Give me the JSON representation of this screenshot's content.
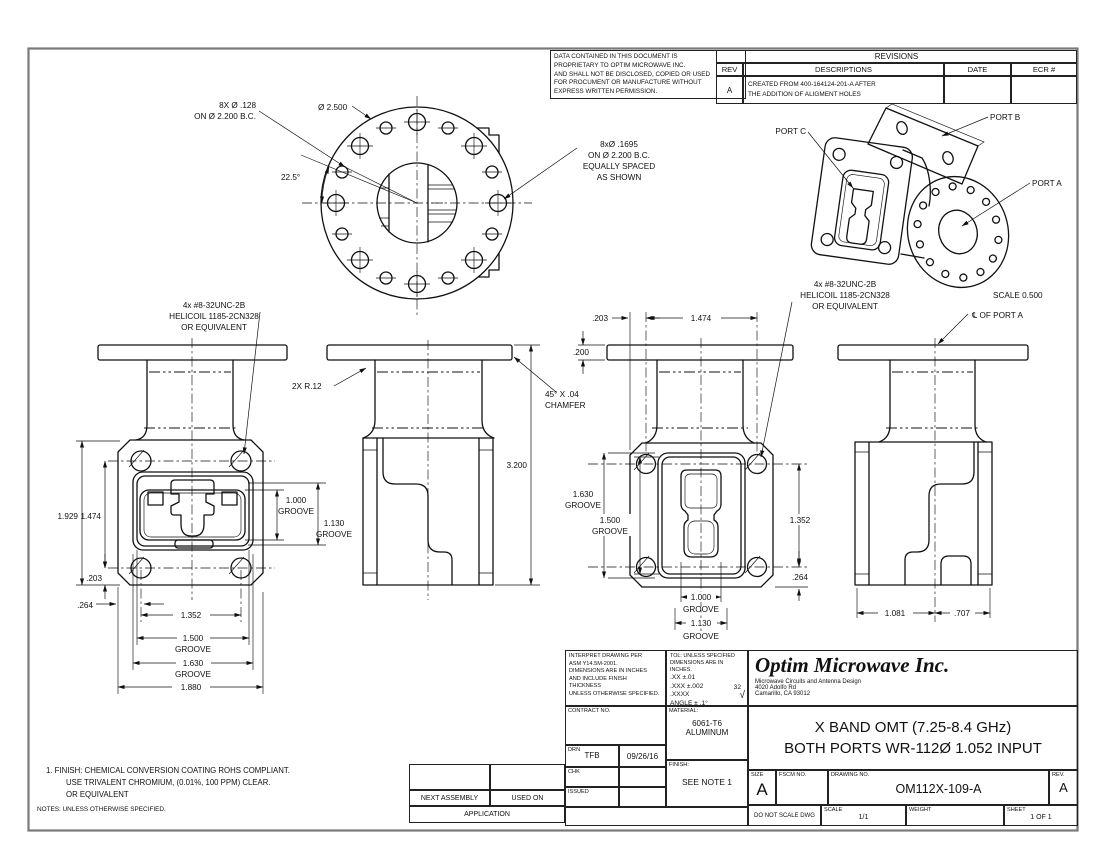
{
  "proprietary": {
    "lines": [
      "DATA CONTAINED IN THIS DOCUMENT IS",
      "PROPRIETARY TO OPTIM MICROWAVE INC.",
      "AND SHALL NOT BE DISCLOSED, COPIED OR USED",
      "FOR PROCUMENT OR MANUFACTURE WITHOUT",
      "EXPRESS WRITTEN PERMISSION."
    ]
  },
  "revisions": {
    "title": "REVISIONS",
    "col_rev": "REV",
    "col_desc": "DESCRIPTIONS",
    "col_date": "DATE",
    "col_ecr": "ECR #",
    "row": {
      "rev": "A",
      "desc1": "CREATED FROM 400-164124-201-A AFTER",
      "desc2": "THE ADDITION OF ALIGMENT HOLES",
      "date": "",
      "ecr": ""
    }
  },
  "round_view": {
    "small_holes1": "8X Ø .128",
    "small_holes2": "ON Ø 2.200 B.C.",
    "diameter": "Ø 2.500",
    "angle": "22.5°",
    "large_holes1": "8xØ .1695",
    "large_holes2": "ON Ø  2.200 B.C.",
    "large_holes3": "EQUALLY SPACED",
    "large_holes4": "AS SHOWN"
  },
  "iso": {
    "port_a": "PORT A",
    "port_b": "PORT B",
    "port_c": "PORT C",
    "scale_note": "SCALE  0.500",
    "cl_note": "℄ OF PORT A"
  },
  "callouts": {
    "helicoil1": "4x #8-32UNC-2B",
    "helicoil2": "HELICOIL 1185-2CN328",
    "helicoil3": "OR EQUIVALENT",
    "radius": "2X R.12",
    "chamfer1": "45° X .04",
    "chamfer2": "CHAMFER"
  },
  "dims": {
    "v1_h": "1.929",
    "v1_holes_v": "1.474",
    "v1_top": ".203",
    "v1_left": ".264",
    "v1_g1000a": "1.000",
    "v1_g1000b": "GROOVE",
    "v1_g1130a": "1.130",
    "v1_g1130b": "GROOVE",
    "v1_holes_h": "1.352",
    "v1_g1500a": "1.500",
    "v1_g1500b": "GROOVE",
    "v1_g1630a": "1.630",
    "v1_g1630b": "GROOVE",
    "v1_w": "1.880",
    "v2_h": "3.200",
    "v3_edge": ".203",
    "v3_holes_h": "1.474",
    "v3_flange": ".200",
    "v3_g1630a": "1.630",
    "v3_g1630b": "GROOVE",
    "v3_g1500a": "1.500",
    "v3_g1500b": "GROOVE",
    "v3_holes_v": "1.352",
    "v3_btm": ".264",
    "v3_g1000a": "1.000",
    "v3_g1000b": "GROOVE",
    "v3_g1130a": "1.130",
    "v3_g1130b": "GROOVE",
    "v4_left": "1.081",
    "v4_right": ".707"
  },
  "notes": {
    "n1": "1.  FINISH: CHEMICAL CONVERSION COATING ROHS COMPLIANT.",
    "n2": "USE TRIVALENT CHROMIUM, (0.01%, 100 PPM) CLEAR.",
    "n3": "OR EQUIVALENT",
    "footer": "NOTES: UNLESS OTHERWISE SPECIFIED."
  },
  "application": {
    "next_assembly": "NEXT ASSEMBLY",
    "used_on": "USED ON",
    "label": "APPLICATION"
  },
  "title_block": {
    "interpret": [
      "INTERPRET DRAWING PER",
      "ASM Y14.5M-2001.",
      "DIMENSIONS ARE IN INCHES",
      "AND INCLUDE FINISH",
      "THICKNESS",
      "UNLESS OTHERWISE SPECIFIED."
    ],
    "tol_header1": "TOL: UNLESS SPECIFIED",
    "tol_header2": "DIMENSIONS ARE IN INCHES.",
    "tol_xx": ".XX  ±.01",
    "tol_xxx": ".XXX ±.002",
    "tol_xxxx": ".XXXX",
    "tol_angle": "ANGLE ± .1°",
    "tol_finish": "32",
    "tol_finish_mark": "√",
    "contract_label": "CONTRACT NO.",
    "material_label": "MATERIAL:",
    "material1": "6061-T6",
    "material2": "ALUMINUM",
    "drn_label": "DRN",
    "drn_name": "TFB",
    "drn_date": "09/26/16",
    "chk_label": "CHK",
    "issued_label": "ISSUED",
    "finish_label": "FINISH:",
    "finish_note": "SEE NOTE 1",
    "company_name": "Optim Microwave Inc.",
    "company_tagline": "Microwave Circuits and Antenna Design",
    "company_addr1": "4020 Adolfo Rd",
    "company_addr2": "Camarillo, CA 93012",
    "title1": "X BAND OMT (7.25-8.4 GHz)",
    "title2": "BOTH PORTS WR-112Ø 1.052 INPUT",
    "size_label": "SIZE",
    "size_value": "A",
    "fscm_label": "FSCM NO.",
    "dwg_label": "DRAWING NO.",
    "dwg_value": "OM112X-109-A",
    "rev_label": "REV.",
    "rev_value": "A",
    "no_scale": "DO NOT SCALE DWG",
    "scale_label": "SCALE",
    "scale_value": "1/1",
    "weight_label": "WEIGHT",
    "sheet_label": "SHEET",
    "sheet_value": "1 OF 1"
  }
}
